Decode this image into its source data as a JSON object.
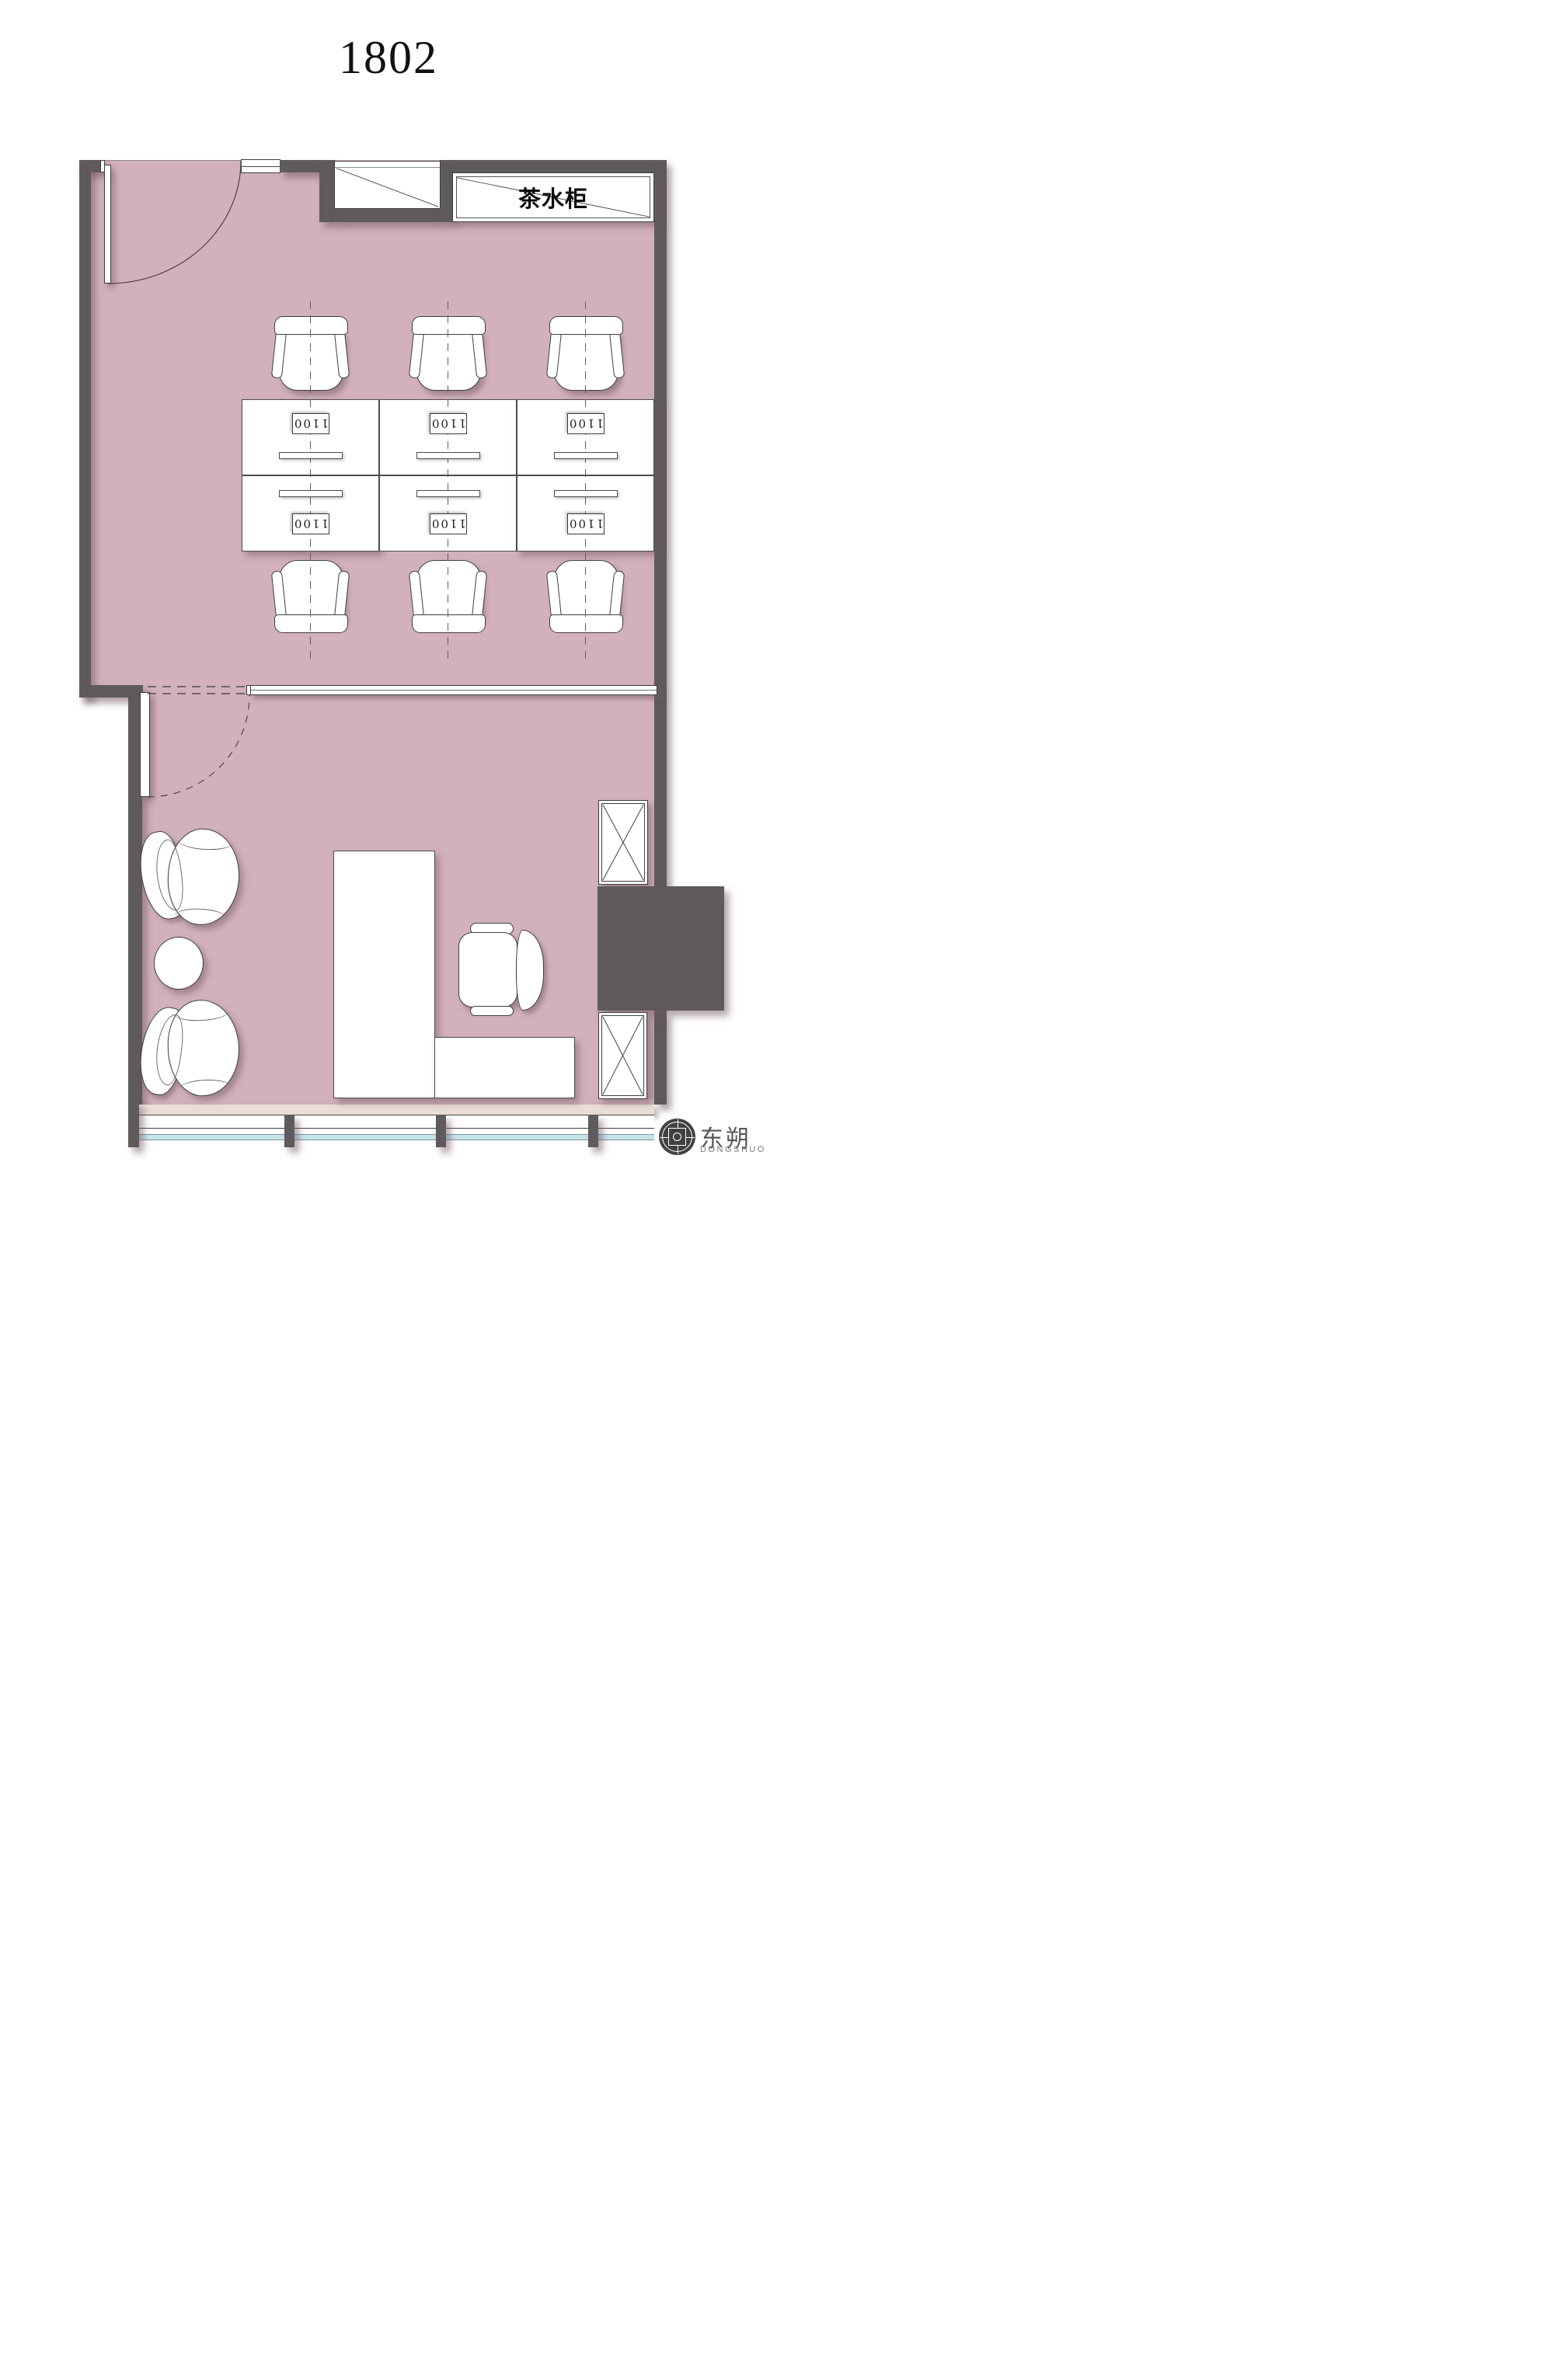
{
  "title": "1802",
  "tea": {
    "label": "茶水柜"
  },
  "workstations": {
    "count": 6,
    "rows": 2,
    "cols": 3,
    "unit_labels": [
      "1100",
      "1100",
      "1100",
      "1100",
      "1100",
      "1100"
    ]
  },
  "logo": {
    "name": "东朔",
    "subtitle": "DONGSHUO"
  },
  "colors": {
    "floor": "#d2b1bb",
    "wall": "#5f5b5c",
    "ledge": "#e9ded7",
    "glass": "#c6e5eb",
    "accent_strip": "#c2a2ad"
  }
}
